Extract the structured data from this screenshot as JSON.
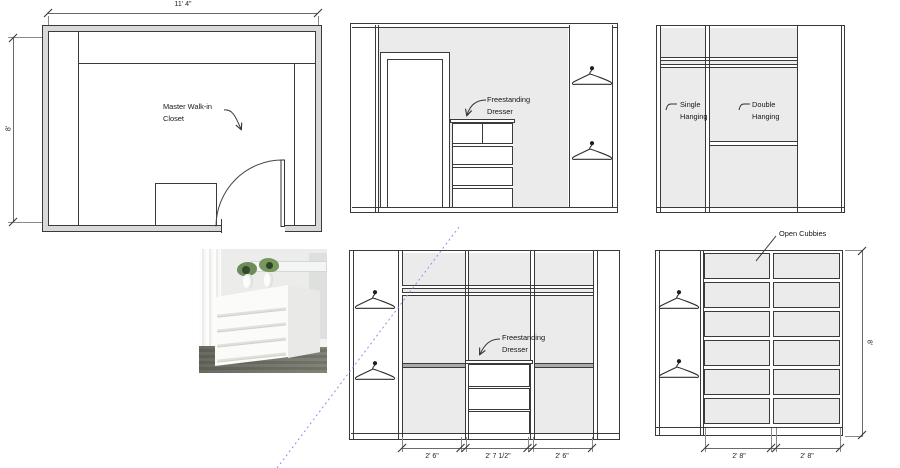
{
  "colors": {
    "line": "#3a3a3a",
    "panel_gray": "#ebebeb",
    "wall_gray": "#d9d9d9",
    "callout_blue": "#8d8df2",
    "shelf_dark": "#a9a9a9"
  },
  "floor_plan": {
    "label_lines": [
      "Master Walk-in",
      "Closet"
    ],
    "dim_width": "11' 4\"",
    "dim_height": "8'"
  },
  "elevation_top_middle": {
    "dresser_label_lines": [
      "Freestanding",
      "Dresser"
    ]
  },
  "elevation_top_right": {
    "single_label_lines": [
      "Single",
      "Hanging"
    ],
    "double_label_lines": [
      "Double",
      "Hanging"
    ]
  },
  "elevation_bottom_middle": {
    "dresser_label_lines": [
      "Freestanding",
      "Dresser"
    ],
    "dims": [
      "2' 6\"",
      "2' 7 1/2\"",
      "2' 6\""
    ]
  },
  "elevation_bottom_right": {
    "cubbies_label": "Open Cubbies",
    "dims": [
      "2' 8\"",
      "2' 8\""
    ],
    "dim_height": "8'"
  }
}
